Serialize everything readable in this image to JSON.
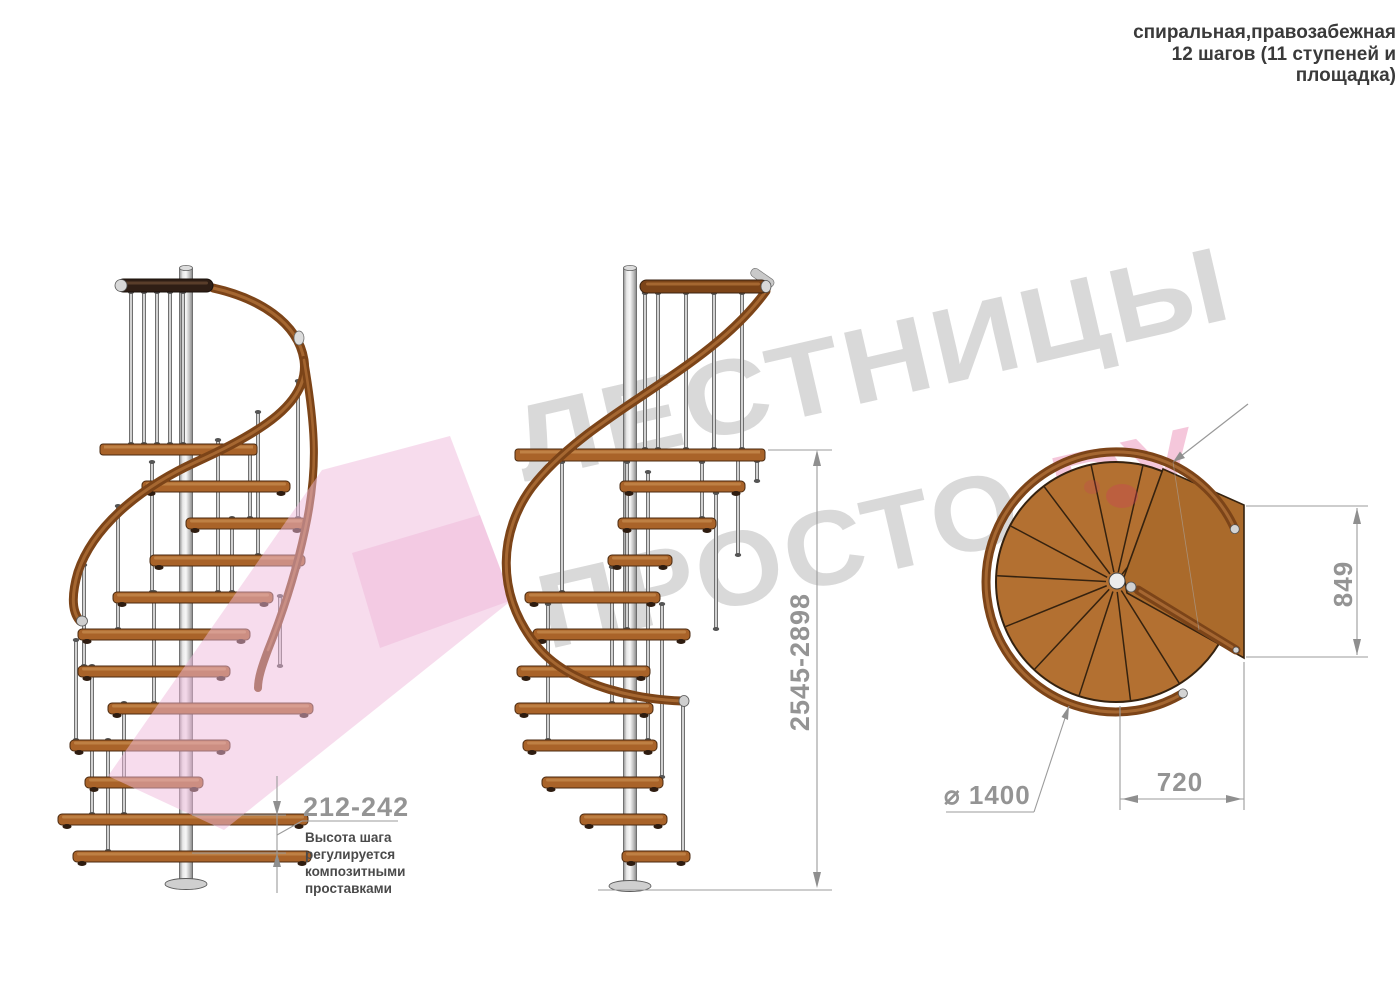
{
  "header": {
    "lines": [
      "спиральная,правозабежная",
      "12 шагов (11 ступеней и",
      "площадка)"
    ]
  },
  "watermark": {
    "word1": "ЛЕСТНИЦЫ",
    "word2": "ПРОСТО",
    "word3": ".РУ"
  },
  "dimensions": {
    "step_height": "212-242",
    "total_height": "2545-2898",
    "platform_depth": "849",
    "platform_width": "720",
    "diameter": "⌀ 1400"
  },
  "note": {
    "step_height_note": "Высота шага регулируется композитными проставками"
  },
  "colors": {
    "wood": "#a96329",
    "rail": "#7c4418",
    "dark_rail": "#2f1e15",
    "pole": "#c9c9c9",
    "dim_line": "#9b9b9b",
    "dim_text": "#949494",
    "watermark_gray": "#d2d2d2",
    "watermark_pink": "#f3bcd6"
  }
}
